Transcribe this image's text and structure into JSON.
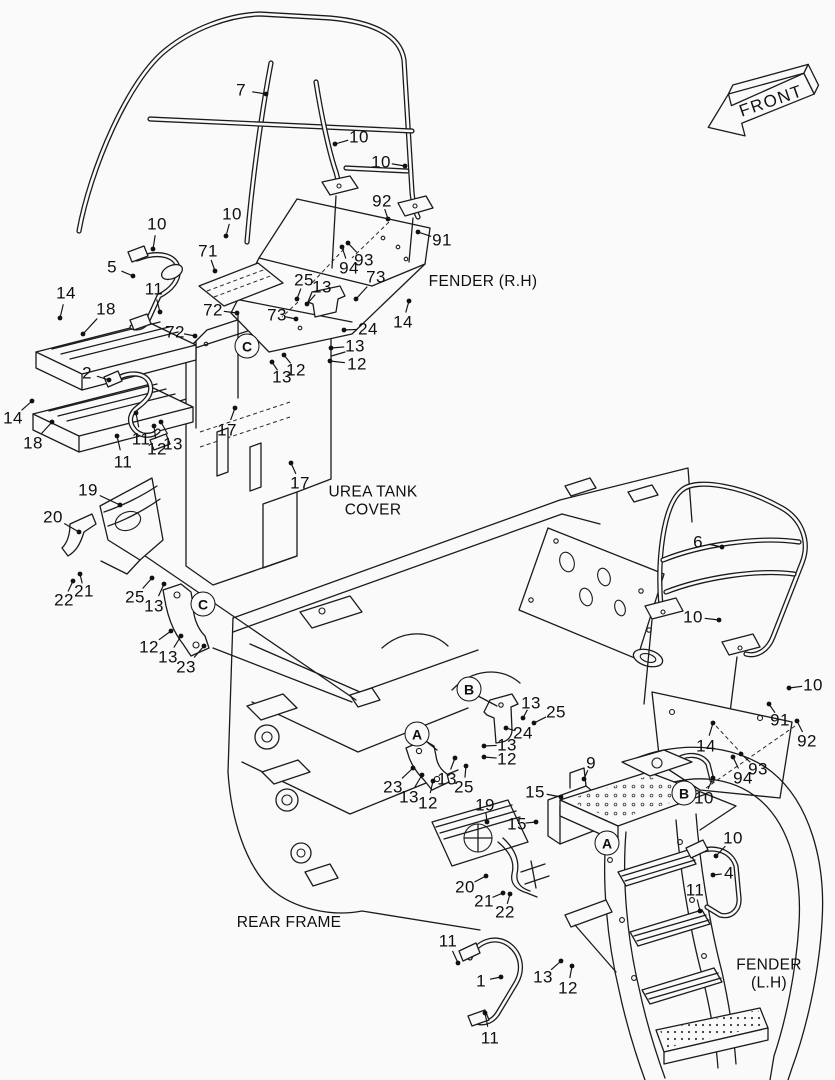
{
  "page": {
    "background": "#fafafa",
    "line_color": "#1b1b1b"
  },
  "front_arrow": {
    "label": "FRONT"
  },
  "captions": [
    {
      "name": "fender-rh",
      "lines": [
        "FENDER (R.H)"
      ],
      "x": 483,
      "y": 282
    },
    {
      "name": "urea-tank-cover",
      "lines": [
        "UREA TANK",
        "COVER"
      ],
      "x": 373,
      "y": 502
    },
    {
      "name": "rear-frame",
      "lines": [
        "REAR FRAME"
      ],
      "x": 289,
      "y": 923
    },
    {
      "name": "fender-lh",
      "lines": [
        "FENDER (L.H)"
      ],
      "x": 769,
      "y": 975
    }
  ],
  "circled_refs": [
    {
      "letter": "C",
      "x": 247,
      "y": 346
    },
    {
      "letter": "C",
      "x": 203,
      "y": 604
    },
    {
      "letter": "B",
      "x": 469,
      "y": 689
    },
    {
      "letter": "A",
      "x": 417,
      "y": 734
    },
    {
      "letter": "B",
      "x": 684,
      "y": 793
    },
    {
      "letter": "A",
      "x": 607,
      "y": 843
    }
  ],
  "callouts": [
    {
      "n": "7",
      "x": 241,
      "y": 90,
      "tx": 266,
      "ty": 94
    },
    {
      "n": "10",
      "x": 359,
      "y": 137,
      "tx": 335,
      "ty": 144
    },
    {
      "n": "10",
      "x": 381,
      "y": 162,
      "tx": 405,
      "ty": 166
    },
    {
      "n": "92",
      "x": 382,
      "y": 201,
      "tx": 388,
      "ty": 219
    },
    {
      "n": "91",
      "x": 442,
      "y": 240,
      "tx": 418,
      "ty": 232
    },
    {
      "n": "93",
      "x": 364,
      "y": 260,
      "tx": 348,
      "ty": 243
    },
    {
      "n": "94",
      "x": 349,
      "y": 268,
      "tx": 342,
      "ty": 247
    },
    {
      "n": "73",
      "x": 376,
      "y": 277,
      "tx": 356,
      "ty": 299
    },
    {
      "n": "25",
      "x": 304,
      "y": 280,
      "tx": 297,
      "ty": 299
    },
    {
      "n": "13",
      "x": 322,
      "y": 287,
      "tx": 307,
      "ty": 304
    },
    {
      "n": "10",
      "x": 157,
      "y": 224,
      "tx": 153,
      "ty": 249
    },
    {
      "n": "10",
      "x": 232,
      "y": 214,
      "tx": 226,
      "ty": 236
    },
    {
      "n": "71",
      "x": 208,
      "y": 251,
      "tx": 215,
      "ty": 271
    },
    {
      "n": "5",
      "x": 112,
      "y": 267,
      "tx": 133,
      "ty": 276
    },
    {
      "n": "14",
      "x": 66,
      "y": 293,
      "tx": 60,
      "ty": 318
    },
    {
      "n": "18",
      "x": 106,
      "y": 309,
      "tx": 83,
      "ty": 334
    },
    {
      "n": "11",
      "x": 154,
      "y": 289,
      "tx": 160,
      "ty": 312
    },
    {
      "n": "72",
      "x": 213,
      "y": 310,
      "tx": 237,
      "ty": 313
    },
    {
      "n": "73",
      "x": 277,
      "y": 315,
      "tx": 296,
      "ty": 319
    },
    {
      "n": "72",
      "x": 175,
      "y": 332,
      "tx": 195,
      "ty": 336
    },
    {
      "n": "12",
      "x": 296,
      "y": 370,
      "tx": 284,
      "ty": 355
    },
    {
      "n": "13",
      "x": 282,
      "y": 377,
      "tx": 272,
      "ty": 362
    },
    {
      "n": "24",
      "x": 368,
      "y": 329,
      "tx": 344,
      "ty": 330
    },
    {
      "n": "13",
      "x": 355,
      "y": 346,
      "tx": 331,
      "ty": 348
    },
    {
      "n": "12",
      "x": 357,
      "y": 364,
      "tx": 330,
      "ty": 361
    },
    {
      "n": "14",
      "x": 403,
      "y": 322,
      "tx": 409,
      "ty": 301
    },
    {
      "n": "2",
      "x": 87,
      "y": 373,
      "tx": 109,
      "ty": 380
    },
    {
      "n": "14",
      "x": 13,
      "y": 418,
      "tx": 32,
      "ty": 401
    },
    {
      "n": "18",
      "x": 33,
      "y": 443,
      "tx": 52,
      "ty": 422
    },
    {
      "n": "11",
      "x": 141,
      "y": 439,
      "tx": 136,
      "ty": 413
    },
    {
      "n": "12",
      "x": 157,
      "y": 449,
      "tx": 154,
      "ty": 426
    },
    {
      "n": "13",
      "x": 173,
      "y": 444,
      "tx": 161,
      "ty": 422
    },
    {
      "n": "11",
      "x": 123,
      "y": 462,
      "tx": 117,
      "ty": 436
    },
    {
      "n": "17",
      "x": 227,
      "y": 430,
      "tx": 235,
      "ty": 408
    },
    {
      "n": "17",
      "x": 300,
      "y": 483,
      "tx": 291,
      "ty": 463
    },
    {
      "n": "19",
      "x": 88,
      "y": 490,
      "tx": 120,
      "ty": 505
    },
    {
      "n": "20",
      "x": 53,
      "y": 517,
      "tx": 79,
      "ty": 532
    },
    {
      "n": "21",
      "x": 84,
      "y": 591,
      "tx": 80,
      "ty": 574
    },
    {
      "n": "22",
      "x": 64,
      "y": 600,
      "tx": 73,
      "ty": 581
    },
    {
      "n": "25",
      "x": 135,
      "y": 597,
      "tx": 152,
      "ty": 578
    },
    {
      "n": "13",
      "x": 154,
      "y": 606,
      "tx": 164,
      "ty": 584
    },
    {
      "n": "12",
      "x": 149,
      "y": 647,
      "tx": 171,
      "ty": 631
    },
    {
      "n": "13",
      "x": 168,
      "y": 657,
      "tx": 181,
      "ty": 636
    },
    {
      "n": "23",
      "x": 186,
      "y": 667,
      "tx": 204,
      "ty": 646
    },
    {
      "n": "13",
      "x": 531,
      "y": 703,
      "tx": 523,
      "ty": 718
    },
    {
      "n": "25",
      "x": 556,
      "y": 712,
      "tx": 534,
      "ty": 723
    },
    {
      "n": "24",
      "x": 523,
      "y": 733,
      "tx": 506,
      "ty": 728
    },
    {
      "n": "13",
      "x": 507,
      "y": 745,
      "tx": 484,
      "ty": 746
    },
    {
      "n": "12",
      "x": 507,
      "y": 759,
      "tx": 484,
      "ty": 757
    },
    {
      "n": "23",
      "x": 393,
      "y": 787,
      "tx": 413,
      "ty": 768
    },
    {
      "n": "13",
      "x": 409,
      "y": 797,
      "tx": 422,
      "ty": 775
    },
    {
      "n": "13",
      "x": 447,
      "y": 779,
      "tx": 455,
      "ty": 758
    },
    {
      "n": "25",
      "x": 464,
      "y": 787,
      "tx": 466,
      "ty": 766
    },
    {
      "n": "12",
      "x": 428,
      "y": 803,
      "tx": 433,
      "ty": 781
    },
    {
      "n": "9",
      "x": 591,
      "y": 763,
      "tx": 584,
      "ty": 779
    },
    {
      "n": "15",
      "x": 535,
      "y": 792,
      "tx": 561,
      "ty": 797
    },
    {
      "n": "15",
      "x": 517,
      "y": 824,
      "tx": 536,
      "ty": 822
    },
    {
      "n": "19",
      "x": 485,
      "y": 805,
      "tx": 487,
      "ty": 822
    },
    {
      "n": "20",
      "x": 465,
      "y": 887,
      "tx": 486,
      "ty": 876
    },
    {
      "n": "21",
      "x": 484,
      "y": 901,
      "tx": 503,
      "ty": 893
    },
    {
      "n": "22",
      "x": 505,
      "y": 912,
      "tx": 510,
      "ty": 894
    },
    {
      "n": "11",
      "x": 448,
      "y": 941,
      "tx": 458,
      "ty": 963
    },
    {
      "n": "1",
      "x": 481,
      "y": 981,
      "tx": 501,
      "ty": 977
    },
    {
      "n": "13",
      "x": 543,
      "y": 977,
      "tx": 561,
      "ty": 961
    },
    {
      "n": "12",
      "x": 568,
      "y": 988,
      "tx": 572,
      "ty": 966
    },
    {
      "n": "11",
      "x": 490,
      "y": 1038,
      "tx": 485,
      "ty": 1013
    },
    {
      "n": "6",
      "x": 698,
      "y": 542,
      "tx": 722,
      "ty": 547
    },
    {
      "n": "10",
      "x": 693,
      "y": 617,
      "tx": 719,
      "ty": 620
    },
    {
      "n": "10",
      "x": 813,
      "y": 685,
      "tx": 789,
      "ty": 688
    },
    {
      "n": "91",
      "x": 780,
      "y": 720,
      "tx": 769,
      "ty": 704
    },
    {
      "n": "92",
      "x": 807,
      "y": 741,
      "tx": 797,
      "ty": 721
    },
    {
      "n": "14",
      "x": 706,
      "y": 746,
      "tx": 713,
      "ty": 723
    },
    {
      "n": "93",
      "x": 758,
      "y": 769,
      "tx": 741,
      "ty": 754
    },
    {
      "n": "94",
      "x": 743,
      "y": 778,
      "tx": 733,
      "ty": 757
    },
    {
      "n": "10",
      "x": 704,
      "y": 798,
      "tx": 713,
      "ty": 778
    },
    {
      "n": "10",
      "x": 733,
      "y": 838,
      "tx": 716,
      "ty": 856
    },
    {
      "n": "4",
      "x": 729,
      "y": 873,
      "tx": 713,
      "ty": 875
    },
    {
      "n": "11",
      "x": 695,
      "y": 890,
      "tx": 700,
      "ty": 911
    }
  ]
}
